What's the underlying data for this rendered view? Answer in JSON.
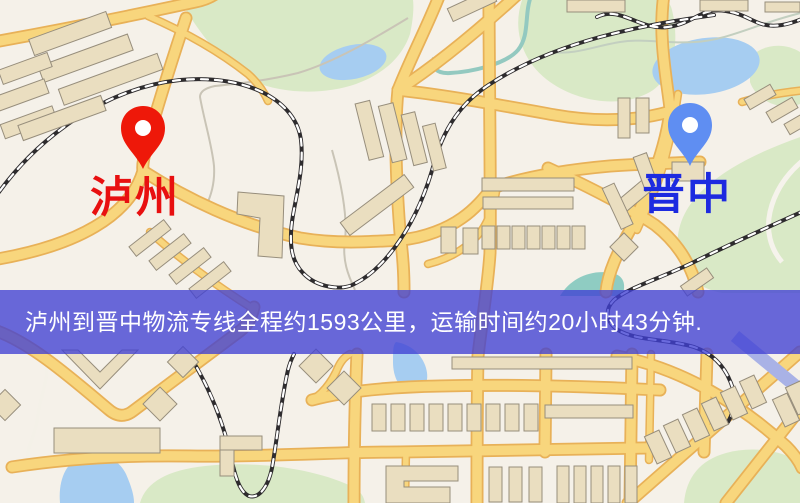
{
  "banner": {
    "text": "泸州到晋中物流专线全程约1593公里，运输时间约20小时43分钟.",
    "background": "rgba(64,64,212,0.78)",
    "text_color": "#ffffff"
  },
  "markers": {
    "origin": {
      "label": "泸州",
      "pin_color": "#ee1809",
      "label_color": "#e81010"
    },
    "destination": {
      "label": "晋中",
      "pin_color": "#5f8ef2",
      "label_color": "#1d2ae0"
    }
  },
  "route": {
    "origin": "泸州",
    "destination": "晋中",
    "service_type": "物流专线",
    "distance": "约1593公里",
    "duration": "约20小时43分钟"
  },
  "map": {
    "palette": {
      "background": "#f5f1e9",
      "park": "#d9e9c6",
      "water": "#a6cdf1",
      "river": "#93c9c0",
      "road_fill": "#f8d67d",
      "road_casing": "#e8b158",
      "building_fill": "#eadec0",
      "building_stroke": "#978e7c",
      "railway": "#2e2c2e",
      "minor_path": "#c9c4b6",
      "blue_road": "#a9b2e6"
    }
  }
}
